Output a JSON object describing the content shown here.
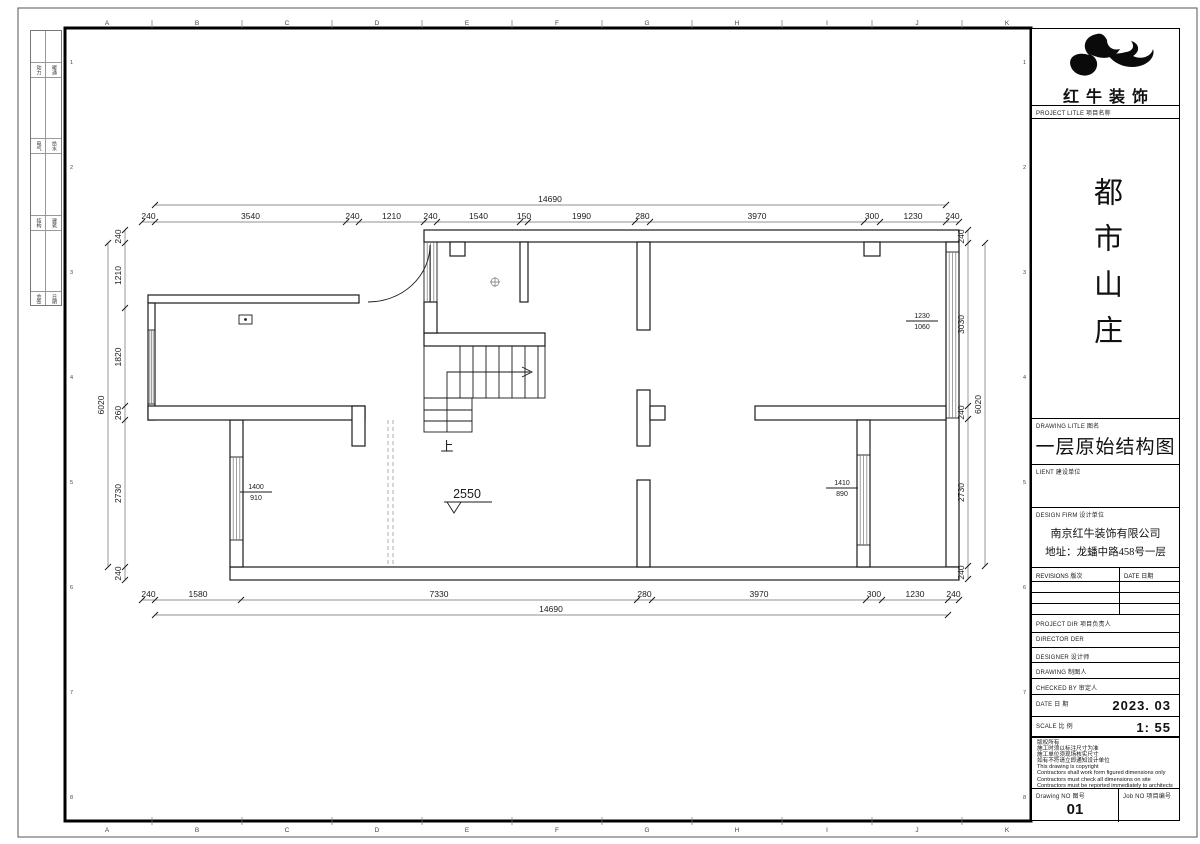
{
  "sheet": {
    "grid_letters": [
      "A",
      "B",
      "C",
      "D",
      "E",
      "F",
      "G",
      "H",
      "I",
      "J",
      "K"
    ],
    "grid_numbers": [
      "1",
      "2",
      "3",
      "4",
      "5",
      "6",
      "7",
      "8"
    ],
    "signature_strip": {
      "rows": [
        [
          "动力",
          "暖通"
        ],
        [
          "电气",
          "给水"
        ],
        [
          "结构",
          "建筑"
        ],
        [
          "会签",
          "日期"
        ]
      ]
    }
  },
  "title_block": {
    "brand": "红牛装饰",
    "project_label": "PROJECT LITLE  项目名称",
    "project_name": "都市山庄",
    "drawing_label": "DRAWING LITLE  图名",
    "drawing_name": "一层原始结构图",
    "client_label": "LIENT  建设单位",
    "design_firm_label": "DESIGN FIRM  设计单位",
    "design_firm_name": "南京红牛装饰有限公司",
    "design_firm_addr": "地址：龙蟠中路458号一层",
    "revisions_label": "REVISIONS  版次",
    "rev_date_label": "DATE 日期",
    "project_dir_label": "PROJECT DIR  项目负责人",
    "director_label": "DIRECTOR DER",
    "designer_label": "DESIGNER  设计师",
    "drawing_by_label": "DRAWING  制图人",
    "checked_by_label": "CHECKED BY  审定人",
    "date_label": "DATE  日 期",
    "date_value": "2023. 03",
    "scale_label": "SCALE  比 例",
    "scale_value": "1: 55",
    "notes": [
      "版权所有",
      "施工时须以标注尺寸为准",
      "施工单位须现场核实尺寸",
      "如有不符请立即通知设计单位",
      "This drawing is copyright",
      "Contractors shall work form figured dimensions only",
      "Contractors must check all dimensions on site",
      "Contractors must be reported immediately to architects"
    ],
    "drawing_no_label": "Drawing NO  图号",
    "drawing_no": "01",
    "job_no_label": "Job NO  项目编号"
  },
  "plan": {
    "dims": {
      "top": [
        "240",
        "3540",
        "240",
        "1210",
        "240",
        "1540",
        "150",
        "1990",
        "280",
        "3970",
        "300",
        "1230",
        "240"
      ],
      "top_overall": "14690",
      "bottom": [
        "240",
        "1580",
        "7330",
        "280",
        "3970",
        "300",
        "1230",
        "240"
      ],
      "bottom_overall": "14690",
      "left": [
        "240",
        "1210",
        "1820",
        "260",
        "2730",
        "240"
      ],
      "left_overall": "6020",
      "right": [
        "240",
        "3030",
        "240",
        "2730",
        "240"
      ],
      "right_overall": "6020"
    },
    "labels": {
      "stair_up": "上",
      "level": "2550",
      "win_right_w": "1230",
      "win_right_h": "1060",
      "win_left_w": "1400",
      "win_left_h": "910",
      "win_br_w": "1410",
      "win_br_h": "890"
    }
  }
}
